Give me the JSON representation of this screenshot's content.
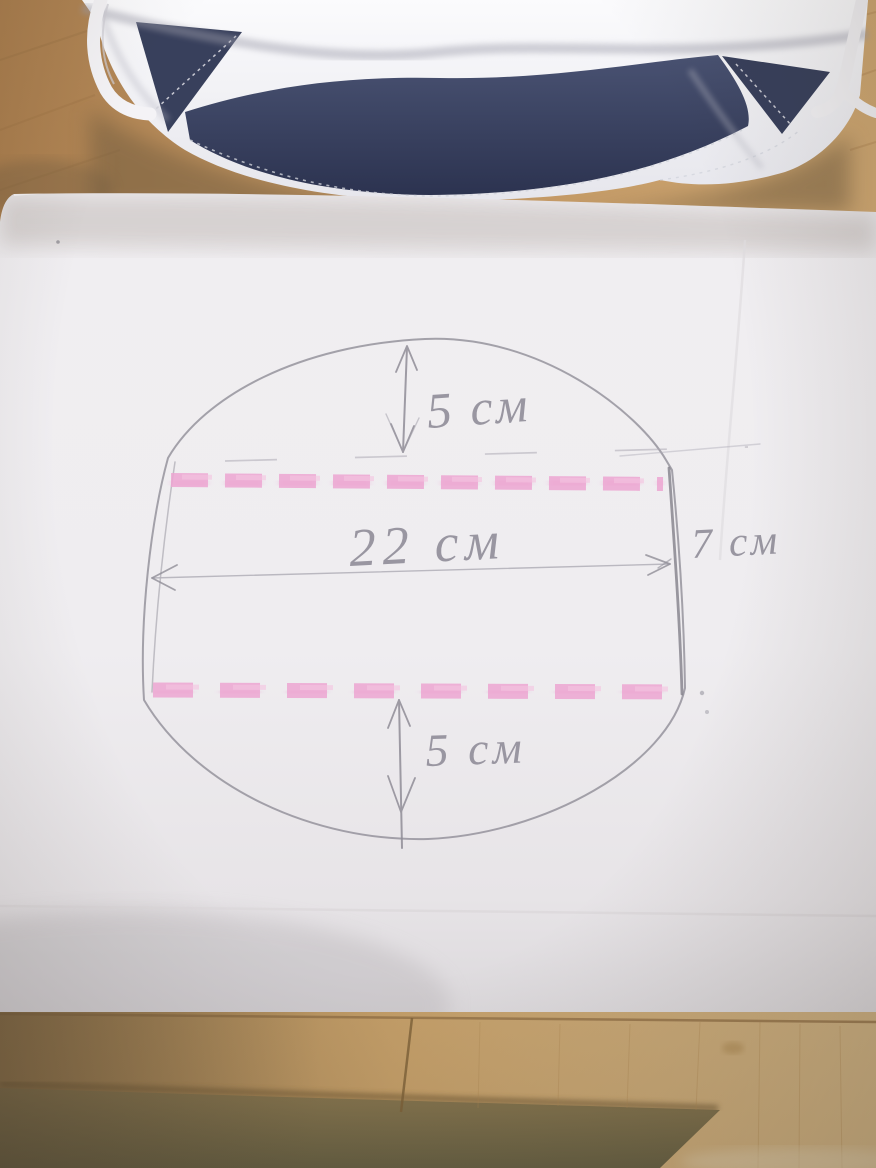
{
  "pattern_annotations": {
    "top_offset": "5 см",
    "width": "22 см",
    "side_depth": "7 см",
    "bottom_offset": "5 см"
  },
  "colors": {
    "marker_pink": "#eda6d2",
    "pencil_gray": "#908d97",
    "mask_navy": "#3a425e",
    "mask_white": "#f3f2f5",
    "paper_white": "#efedf0",
    "wood_tan": "#c49b66"
  }
}
